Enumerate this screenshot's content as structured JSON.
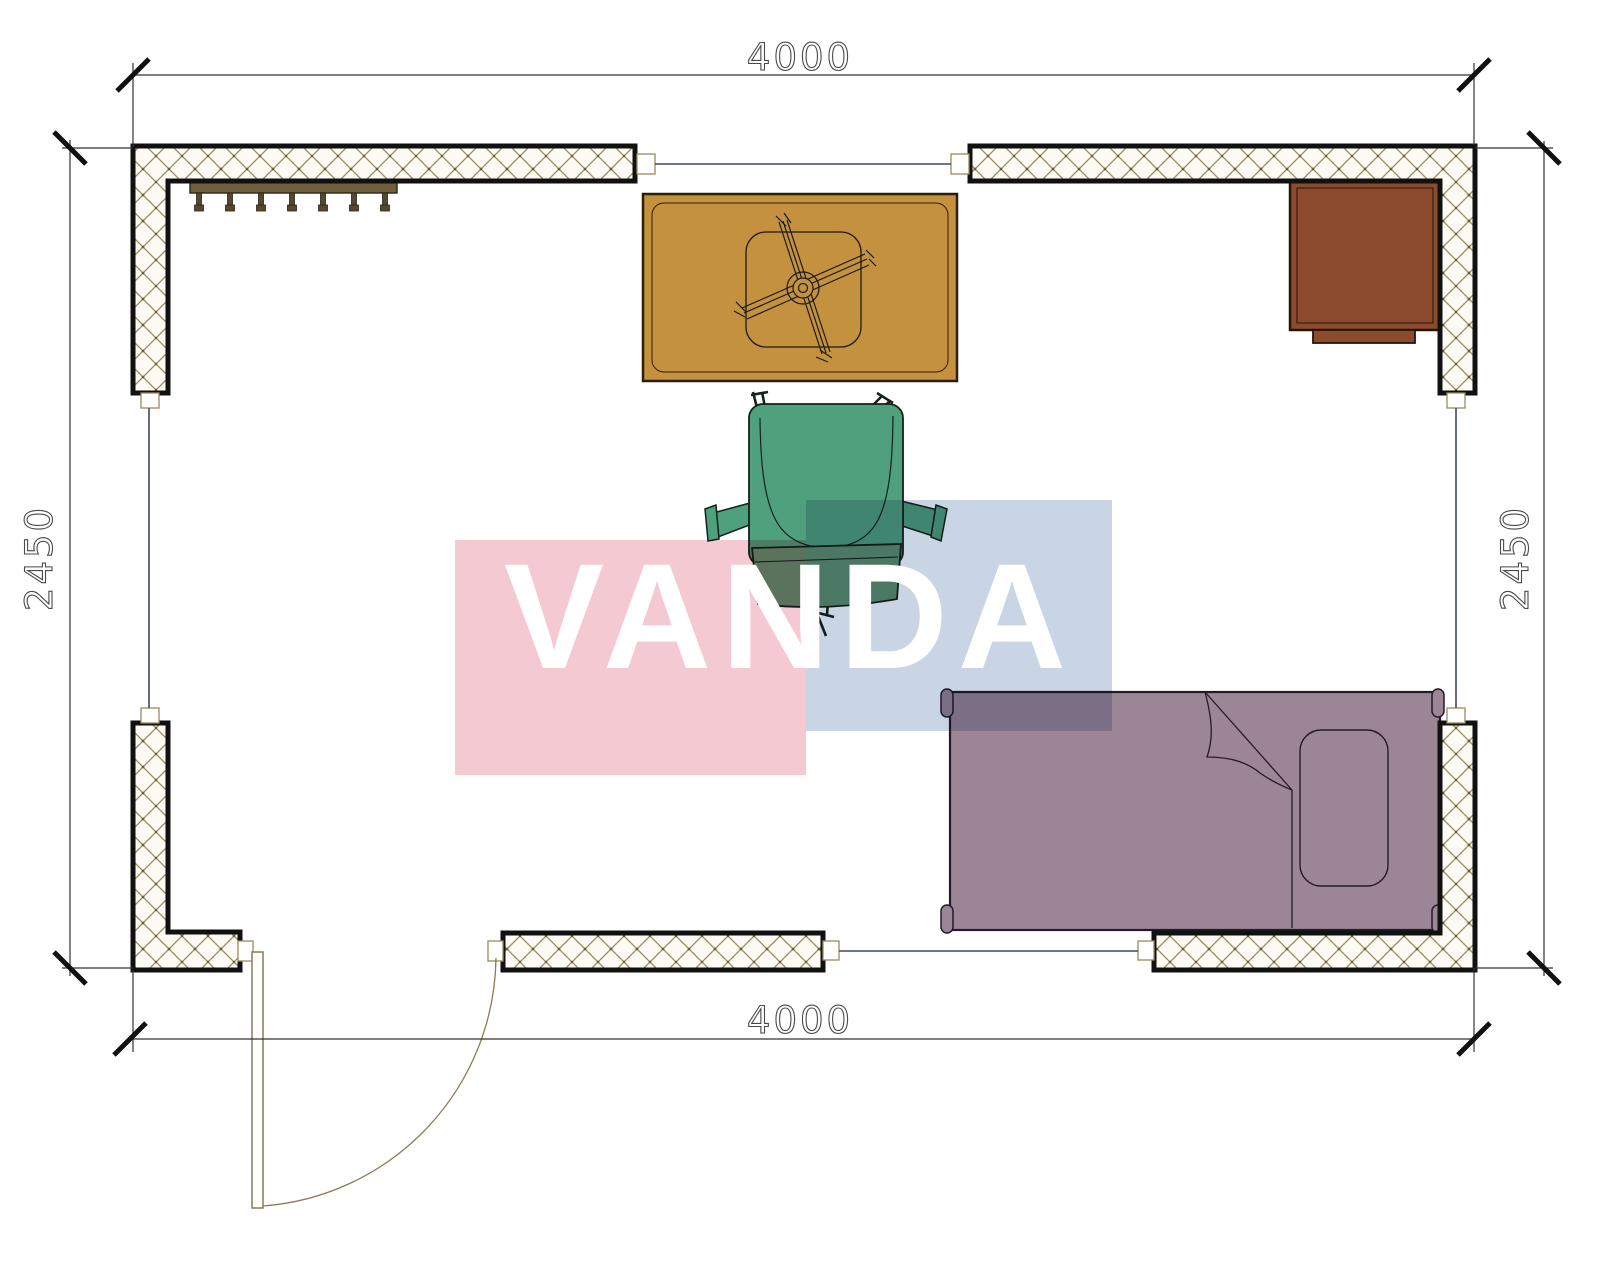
{
  "title": "Room floor plan 4000 x 2450",
  "dimensions": {
    "top": "4000",
    "bottom": "4000",
    "left": "2450",
    "right": "2450"
  },
  "room": {
    "width_mm": 4000,
    "depth_mm": 2450
  },
  "watermark": {
    "text": "VANDA",
    "pink": "#f5c9d2",
    "blue": "#c9d4e4",
    "text_color": "#ffffff"
  },
  "colors": {
    "wall_fill": "#fdfbf4",
    "wall_hatch": "#9a8a5e",
    "wall_border": "#111111",
    "window": "#3c4668",
    "dim_line": "#333333",
    "dim_text": "#4a4a4a",
    "table": "#c4913f",
    "table_edge": "#2b1f08",
    "chair": "#4fa07c",
    "chair_back": "#5f9070",
    "chair_edge": "#15211b",
    "bed": "#9c8595",
    "bed_edge": "#231a2b",
    "desk": "#8c4b2d",
    "desk_edge": "#26150b",
    "shelf": "#6f5f3c",
    "hook": "#55482e",
    "door": "#8a7b52"
  },
  "furniture": [
    {
      "name": "coat-rack",
      "wall": "top-left"
    },
    {
      "name": "table-with-fan-base",
      "area": "top-center"
    },
    {
      "name": "office-chair",
      "area": "center"
    },
    {
      "name": "desk",
      "area": "top-right-corner"
    },
    {
      "name": "single-bed",
      "area": "bottom-right"
    },
    {
      "name": "door-swing",
      "area": "bottom-left"
    }
  ]
}
